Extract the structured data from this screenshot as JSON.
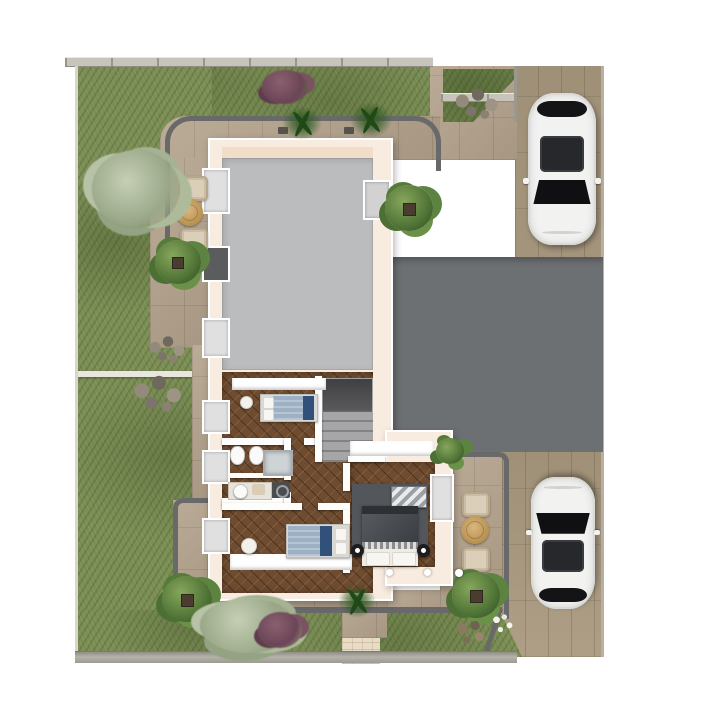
{
  "palette": {
    "page_bg": "#ffffff",
    "grass": "#7b8e54",
    "paving_tile": "#b3a28c",
    "paving_border": "#696969",
    "plank_driveway": "#a9997f",
    "terrace_slab": "#6d7073",
    "wall_cream": "#f8ece1",
    "interior_wall": "#fdfdfc",
    "room_gray": "#bbbcbe",
    "room_peach": "#f2ddc9",
    "floor_wood": "#6f4b2f",
    "rug_gray": "#53575b",
    "bed_blue": "#9db0c4",
    "bed_dark_duvet": "#44484d",
    "throw_navy": "#31507a",
    "car_white": "#f2f2f1",
    "car_glass": "#1a1a1c",
    "patio_table_wood": "#c89f66",
    "patio_chair_beige": "#dccfba",
    "fence_gray": "#c6c4bb",
    "retaining_wall": "#a5a39a",
    "walkway_beige": "#e9dcc6",
    "bush_green": "#55793a",
    "bush_silver": "#aebb9a",
    "bush_purple": "#6b4556",
    "stair_gray": "#8e8e90"
  },
  "scene": {
    "type": "3d-floor-plan-top-view",
    "building": {
      "upper_room": "large-empty-gray-room",
      "rooms": [
        {
          "name": "bedroom-1",
          "furniture": [
            "double-bed-blue",
            "plant-pot"
          ]
        },
        {
          "name": "bathroom",
          "furniture": [
            "wall-hung-toilet",
            "bidet",
            "shower-cabin"
          ]
        },
        {
          "name": "shower-room",
          "furniture": [
            "vanity-with-round-basin",
            "washing-machine",
            "bath-mat"
          ]
        },
        {
          "name": "bedroom-2",
          "furniture": [
            "double-bed-blue",
            "pouf"
          ]
        },
        {
          "name": "hallway",
          "furniture": [
            "staircase"
          ]
        },
        {
          "name": "master-bedroom",
          "furniture": [
            "double-bed-dark",
            "area-rug",
            "patterned-dresser",
            "side-table-left",
            "side-table-right"
          ]
        }
      ]
    },
    "vehicles": [
      {
        "name": "car-top-right",
        "color": "white",
        "facing": "south",
        "location": "plank-driveway"
      },
      {
        "name": "car-bottom-right",
        "color": "white",
        "facing": "north",
        "location": "stone-driveway"
      }
    ],
    "outdoor": {
      "patio_sets": [
        {
          "name": "patio-set-west",
          "items": [
            "round-table",
            "armchair",
            "armchair"
          ]
        },
        {
          "name": "patio-set-east",
          "items": [
            "round-table",
            "armchair",
            "armchair"
          ]
        }
      ],
      "areas": [
        "garden-lawn-west",
        "garden-strip-north",
        "garden-strip-south",
        "grass-patch-northeast",
        "tile-paving",
        "plank-driveway",
        "concrete-terrace",
        "entrance-walkway"
      ],
      "plants": [
        "green-bush-with-planter",
        "fern",
        "silver-shrub",
        "purple-shrub",
        "rock-cluster",
        "white-flower-patch",
        "dry-shrub"
      ],
      "boundary": [
        "north-fence",
        "south-retaining-wall"
      ]
    }
  }
}
